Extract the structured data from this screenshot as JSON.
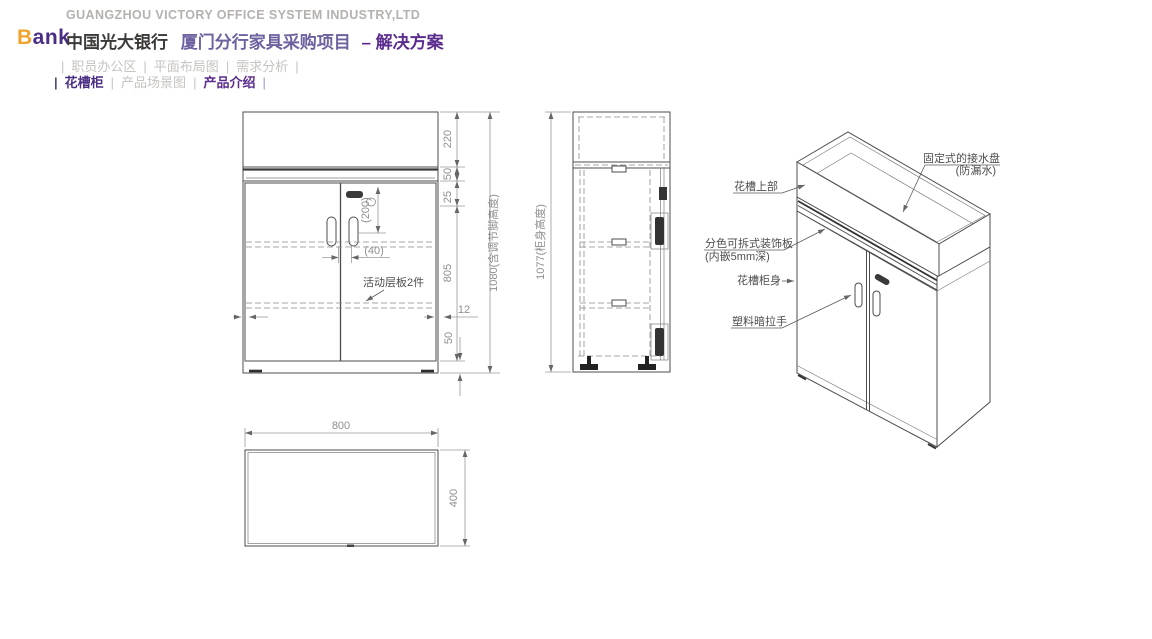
{
  "header": {
    "company": "GUANGZHOU VICTORY OFFICE SYSTEM INDUSTRY,LTD",
    "logo_b": "B",
    "logo_rest": "ank",
    "bank": "中国光大银行",
    "project": "厦门分行家具采购项目",
    "subtitle": "– 解决方案",
    "sep": "|",
    "nav1": {
      "i0": "职员办公区",
      "i1": "平面布局图",
      "i2": "需求分析"
    },
    "nav2": {
      "i0": "花槽柜",
      "i1": "产品场景图",
      "i2": "产品介绍"
    }
  },
  "front": {
    "d220": "220",
    "d50": "50",
    "d25": "25",
    "d805": "805",
    "d1080": "1080(含调节脚高度)",
    "d200": "(200)",
    "d40": "(40)",
    "d12": "12",
    "d50_base": "50",
    "shelf_note": "活动层板2件"
  },
  "side": {
    "d1077": "1077(柜身高度)"
  },
  "plan": {
    "width": "800",
    "depth": "400"
  },
  "iso": {
    "tray1": "固定式的接水盘",
    "tray2": "(防漏水)",
    "top_part": "花槽上部",
    "panel1": "分色可拆式装饰板",
    "panel2": "(内嵌5mm深)",
    "body": "花槽柜身",
    "handle": "塑料暗拉手"
  },
  "colors": {
    "purple": "#5b2d8e",
    "orange": "#f0a32f",
    "light_gray": "#b4b1ae"
  }
}
